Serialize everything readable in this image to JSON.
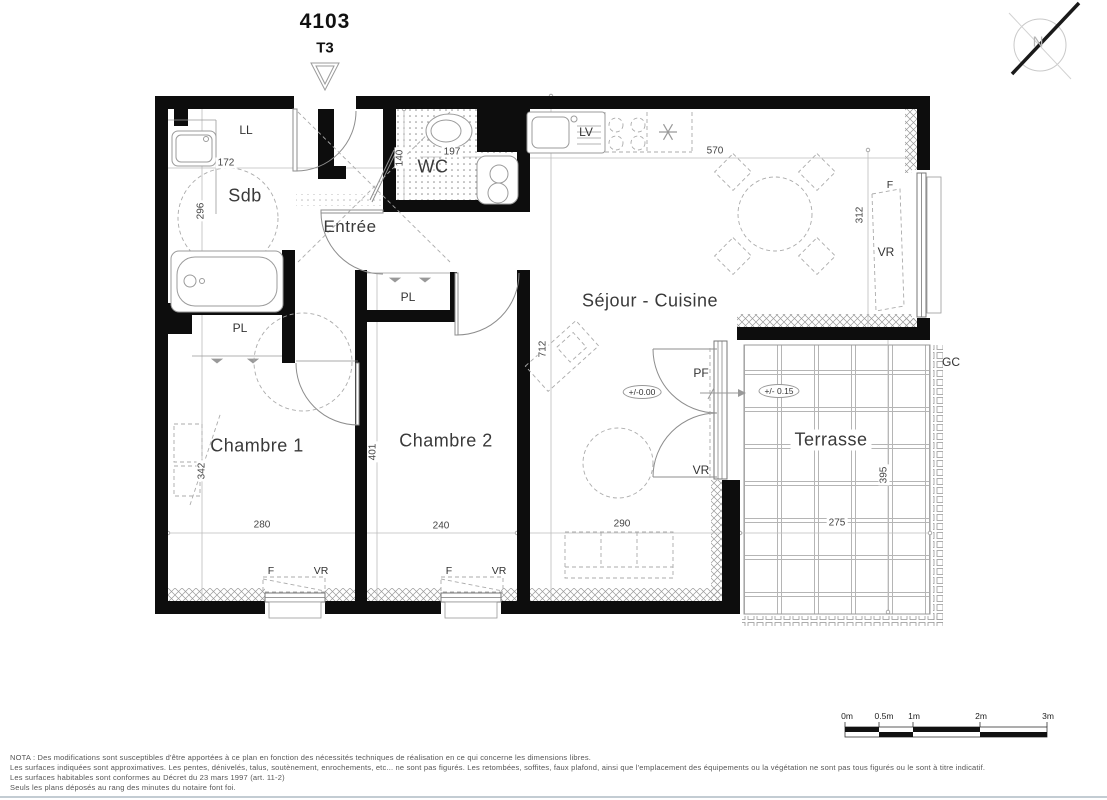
{
  "header": {
    "unit_number": "4103",
    "unit_type": "T3"
  },
  "compass": {
    "north_label": "N"
  },
  "rooms": {
    "sdb": "Sdb",
    "entree": "Entrée",
    "wc": "WC",
    "sejour_cuisine": "Séjour - Cuisine",
    "chambre1": "Chambre 1",
    "chambre2": "Chambre 2",
    "terrasse": "Terrasse"
  },
  "fixtures": {
    "washing_machine": "LL",
    "dishwasher": "LV",
    "closet_chambre1": "PL",
    "closet_chambre2": "PL",
    "french_window": "PF",
    "railing": "GC",
    "window_sejour": "F",
    "shutter_sejour": "VR",
    "shutter_terrace_door": "VR",
    "window_chambre1": "F",
    "shutter_chambre1": "VR",
    "window_chambre2": "F",
    "shutter_chambre2": "VR"
  },
  "levels": {
    "sejour": "+/-0.00",
    "terrasse": "+/- 0.15"
  },
  "dimensions_cm": {
    "sdb_width": "172",
    "sdb_depth": "296",
    "wc_depth": "140",
    "wc_width": "197",
    "kitchen_width": "570",
    "sejour_window": "312",
    "sejour_depth": "712",
    "chambre2_depth": "401",
    "chambre1_wardrobe": "342",
    "chambre1_width": "280",
    "chambre2_width": "240",
    "sejour_width": "290",
    "terrasse_width": "275",
    "terrasse_depth": "395"
  },
  "scale_bar": {
    "labels": [
      "0m",
      "0.5m",
      "1m",
      "2m",
      "3m"
    ]
  },
  "nota": {
    "line1": "NOTA : Des modifications sont susceptibles d'être apportées à ce plan en fonction des nécessités techniques de réalisation en ce qui concerne les dimensions libres.",
    "line2": "Les surfaces indiquées sont approximatives. Les pentes, dénivelés, talus, soutènement, enrochements, etc... ne sont pas figurés. Les retombées, soffites, faux plafond, ainsi que l'emplacement des équipements ou la végétation ne sont pas tous figurés ou le sont à titre indicatif.",
    "line3": "Les surfaces habitables sont conformes au Décret du 23 mars 1997 (art. 11-2)",
    "line4": "Seuls les plans déposés au rang des minutes du notaire font foi."
  }
}
